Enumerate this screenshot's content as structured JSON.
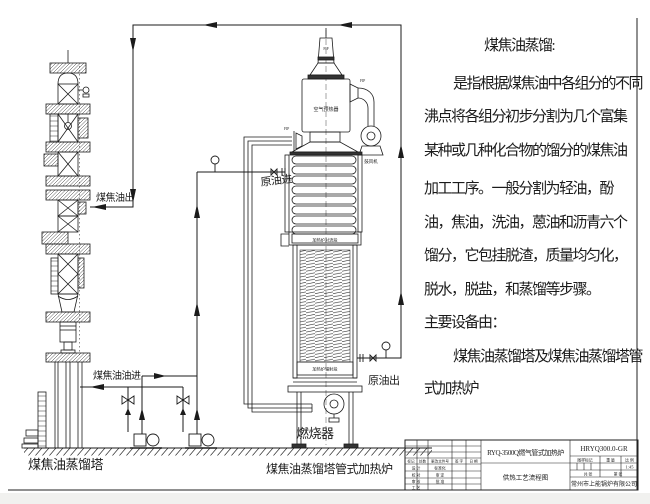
{
  "description": {
    "title": "煤焦油蒸馏:",
    "lines": [
      "是指根据煤焦油中各组分的不同",
      "沸点将各组分初步分割为几个富集",
      "某种或几种化合物的馏分的煤焦油",
      "加工工序。一般分割为轻油，酚",
      "油，焦油，洗油，蒽油和沥青六个",
      "馏分，它包挂脱渣，质量均匀化，",
      "脱水，脱盐，和蒸馏等步骤。",
      "主要设备由：",
      "煤焦油蒸馏塔及煤焦油蒸馏塔管",
      "式加热炉"
    ]
  },
  "diagram": {
    "tower_name": "煤焦油蒸馏塔",
    "furnace_name": "煤焦油蒸馏塔管式加热炉",
    "coal_tar_out": "煤焦油出",
    "coal_tar_in": "煤焦油油进",
    "crude_oil_in": "原油进",
    "crude_oil_out": "原油出",
    "burner": "燃烧器",
    "air_preheater": "空气预热器",
    "blower": "鼓风机",
    "convection_band": "加热炉对流段",
    "radiant_band": "加热炉辐射段",
    "instrument_tag": "FIP"
  },
  "title_block": {
    "product": "RYQ-3500Q燃气管式加热炉",
    "sheet_name": "供热工艺流程图",
    "drawing_no": "HRYQ300.0-GR",
    "company": "常州市上能锅炉有限公司",
    "rev_header": {
      "mark": "标记",
      "count": "处数",
      "doc": "更改文件号",
      "sign": "签 字",
      "date": "日 期"
    },
    "staff": {
      "r1l": "设 计",
      "r1m": "标准化",
      "r2l": "校 对",
      "r2m": "审 定",
      "r3l": "审 核",
      "r3m": "批 准",
      "r4l": "工 艺"
    },
    "right": {
      "stamp": "图样标记",
      "weight": "重 量",
      "scale": "比 例",
      "scale_value": "1:45",
      "total": "共 张",
      "number": "第 张"
    }
  }
}
